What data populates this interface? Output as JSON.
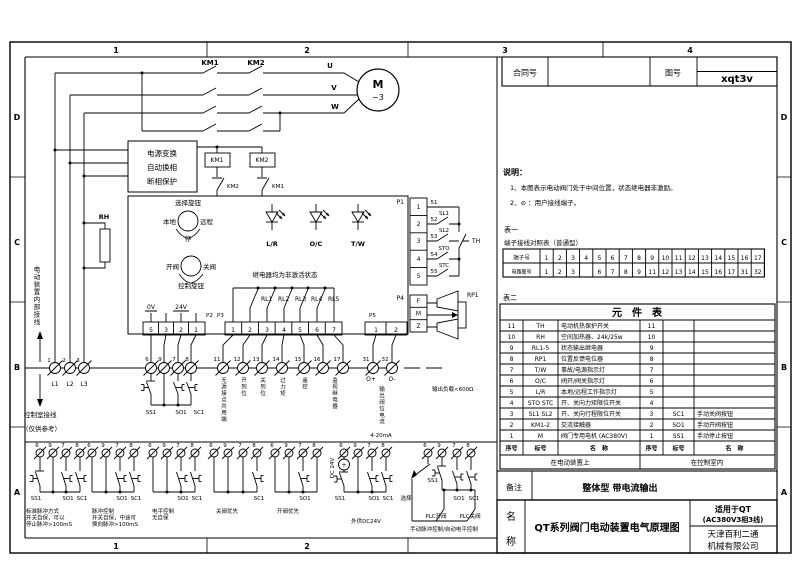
{
  "frame": {
    "columns": [
      "1",
      "2",
      "3",
      "4"
    ],
    "rows": [
      "D",
      "C",
      "B",
      "A"
    ]
  },
  "title_top": {
    "contract_label": "合同号",
    "drawing_label": "图号",
    "drawing_number": "xqt3v"
  },
  "notes": {
    "heading": "说明：",
    "line1": "1、本图表示电动阀门处于中间位置，状态继电器非激励。",
    "line2": "2、⊘ ：用户接线端子。"
  },
  "table1": {
    "caption": "表一",
    "title": "端子接线对照表（普通型）",
    "row1_label": "端子号",
    "row2_label": "电路图号",
    "terminals": [
      "1",
      "2",
      "3",
      "4",
      "5",
      "6",
      "7",
      "8",
      "9",
      "10",
      "11",
      "12",
      "13",
      "14",
      "15",
      "16",
      "17"
    ],
    "circuit": [
      "1",
      "2",
      "3",
      "",
      "6",
      "7",
      "8",
      "9",
      "11",
      "12",
      "13",
      "14",
      "15",
      "16",
      "17",
      "31",
      "32"
    ]
  },
  "table2": {
    "caption": "表二",
    "title": "元　件　表",
    "rows": [
      [
        "11",
        "TH",
        "电动机热保护开关",
        "11",
        "",
        ""
      ],
      [
        "10",
        "RH",
        "空间加热器、24k/25w",
        "10",
        "",
        ""
      ],
      [
        "9",
        "RL1-5",
        "状态输出继电器",
        "9",
        "",
        ""
      ],
      [
        "8",
        "RP1",
        "位置反馈电位器",
        "8",
        "",
        ""
      ],
      [
        "7",
        "T/W",
        "事故/电源指示灯",
        "7",
        "",
        ""
      ],
      [
        "6",
        "O/C",
        "阀开/阀关指示灯",
        "6",
        "",
        ""
      ],
      [
        "5",
        "L/R",
        "本地/远程工作指示灯",
        "5",
        "",
        ""
      ],
      [
        "4",
        "STO STC",
        "开、关向力矩限位开关",
        "4",
        "",
        ""
      ],
      [
        "3",
        "SL1 SL2",
        "开、关向行程限位开关",
        "3",
        "SC1",
        "手动关阀按钮"
      ],
      [
        "2",
        "KM1-2",
        "交流接触器",
        "2",
        "SO1",
        "手动开阀按钮"
      ],
      [
        "1",
        "M",
        "阀门专用电机 (AC380V)",
        "1",
        "SS1",
        "手动停止按钮"
      ]
    ],
    "footer": [
      "序号",
      "标号",
      "名　称",
      "序号",
      "标号",
      "名　称"
    ],
    "loc_left": "在电动装置上",
    "loc_right": "在控制室内"
  },
  "remark": {
    "label": "备注",
    "value": "整体型  带电流输出"
  },
  "title_bottom": {
    "name_char1": "名",
    "name_char2": "称",
    "title": "QT系列阀门电动装置电气原理图",
    "apply1": "适用于QT",
    "apply2": "(AC380V3相3线)",
    "company1": "天津百利二通",
    "company2": "机械有限公司"
  },
  "schematic": {
    "km1": "KM1",
    "km2": "KM2",
    "u": "U",
    "v": "V",
    "w": "W",
    "m": "M",
    "ph3": "~3",
    "pb1": "电源变换",
    "pb2": "自动换相",
    "pb3": "断相保护",
    "rh": "RH",
    "sel_knob": "选择旋钮",
    "local": "本地",
    "remote": "远程",
    "stop": "停",
    "open": "开阀",
    "close": "关阀",
    "ctrl_knob": "控制旋钮",
    "lr": "L/R",
    "oc": "O/C",
    "tw": "T/W",
    "relay_note": "继电器均为非激活状态",
    "rl1": "RL1",
    "rl2": "RL2",
    "rl3": "RL3",
    "rl4": "RL4",
    "rl5": "RL5",
    "p1": "P1",
    "p2": "P2",
    "p3": "P3",
    "p4": "P4",
    "p5": "P5",
    "v0": "0V",
    "v24": "24V",
    "p1_pins": [
      "1",
      "2",
      "3",
      "4",
      "5"
    ],
    "p2_pins": [
      "5",
      "3",
      "2",
      "1"
    ],
    "p3_pins": [
      "1",
      "2",
      "3",
      "4",
      "5",
      "6",
      "7"
    ],
    "p4_pins": [
      "F",
      "M",
      "Z"
    ],
    "p5_pins": [
      "1",
      "2"
    ],
    "wire_nums": [
      "51",
      "52",
      "53",
      "54",
      "55"
    ],
    "sl1": "SL1",
    "sl2": "SL2",
    "sto": "STO",
    "stc": "STC",
    "th": "TH",
    "rp1": "RP1",
    "inner_wiring": "电动装置内部接线",
    "outer_wiring": "控制室接线",
    "ref_only": "（仅供参考）",
    "phase_terms": [
      [
        "1",
        "L1"
      ],
      [
        "2",
        "L2"
      ],
      [
        "3",
        "L3"
      ]
    ],
    "ctrl_terms": [
      "6",
      "9",
      "7",
      "8"
    ],
    "sig_terms": [
      "11",
      "12",
      "13",
      "14",
      "15",
      "16",
      "17"
    ],
    "out_terms": [
      "31",
      "32"
    ],
    "ss1": "SS1",
    "so1": "SO1",
    "sc1": "SC1",
    "t11": "无源接点共用端",
    "t12": "开到位",
    "t13": "关到位",
    "t14": "过力矩",
    "t15": "遥控",
    "t1617": "监视继电器",
    "op": "O+",
    "om": "O-",
    "out_current": "输出阀位电流",
    "ma": "4-20mA",
    "load": "输出负载<600Ω",
    "plus": "+",
    "g1c1": "标准脉冲方式",
    "g1c2": "开关自保，可以",
    "g1c3": "停止脉冲>100mS",
    "g2c1": "脉冲控制",
    "g2c2": "开关自保，中途可",
    "g2c3": "换向脉冲>100mS",
    "g3c1": "电平控制",
    "g3c2": "无自保",
    "g4c1": "关阀优先",
    "g5c1": "开阀优先",
    "g6c1": "外供DC24V",
    "dc24": "DC 24V",
    "g7_sel": "选择",
    "plc_open": "PLC开阀",
    "plc_close": "PLC关阀",
    "g7c1": "手动脉冲控制/自动电平控制"
  }
}
